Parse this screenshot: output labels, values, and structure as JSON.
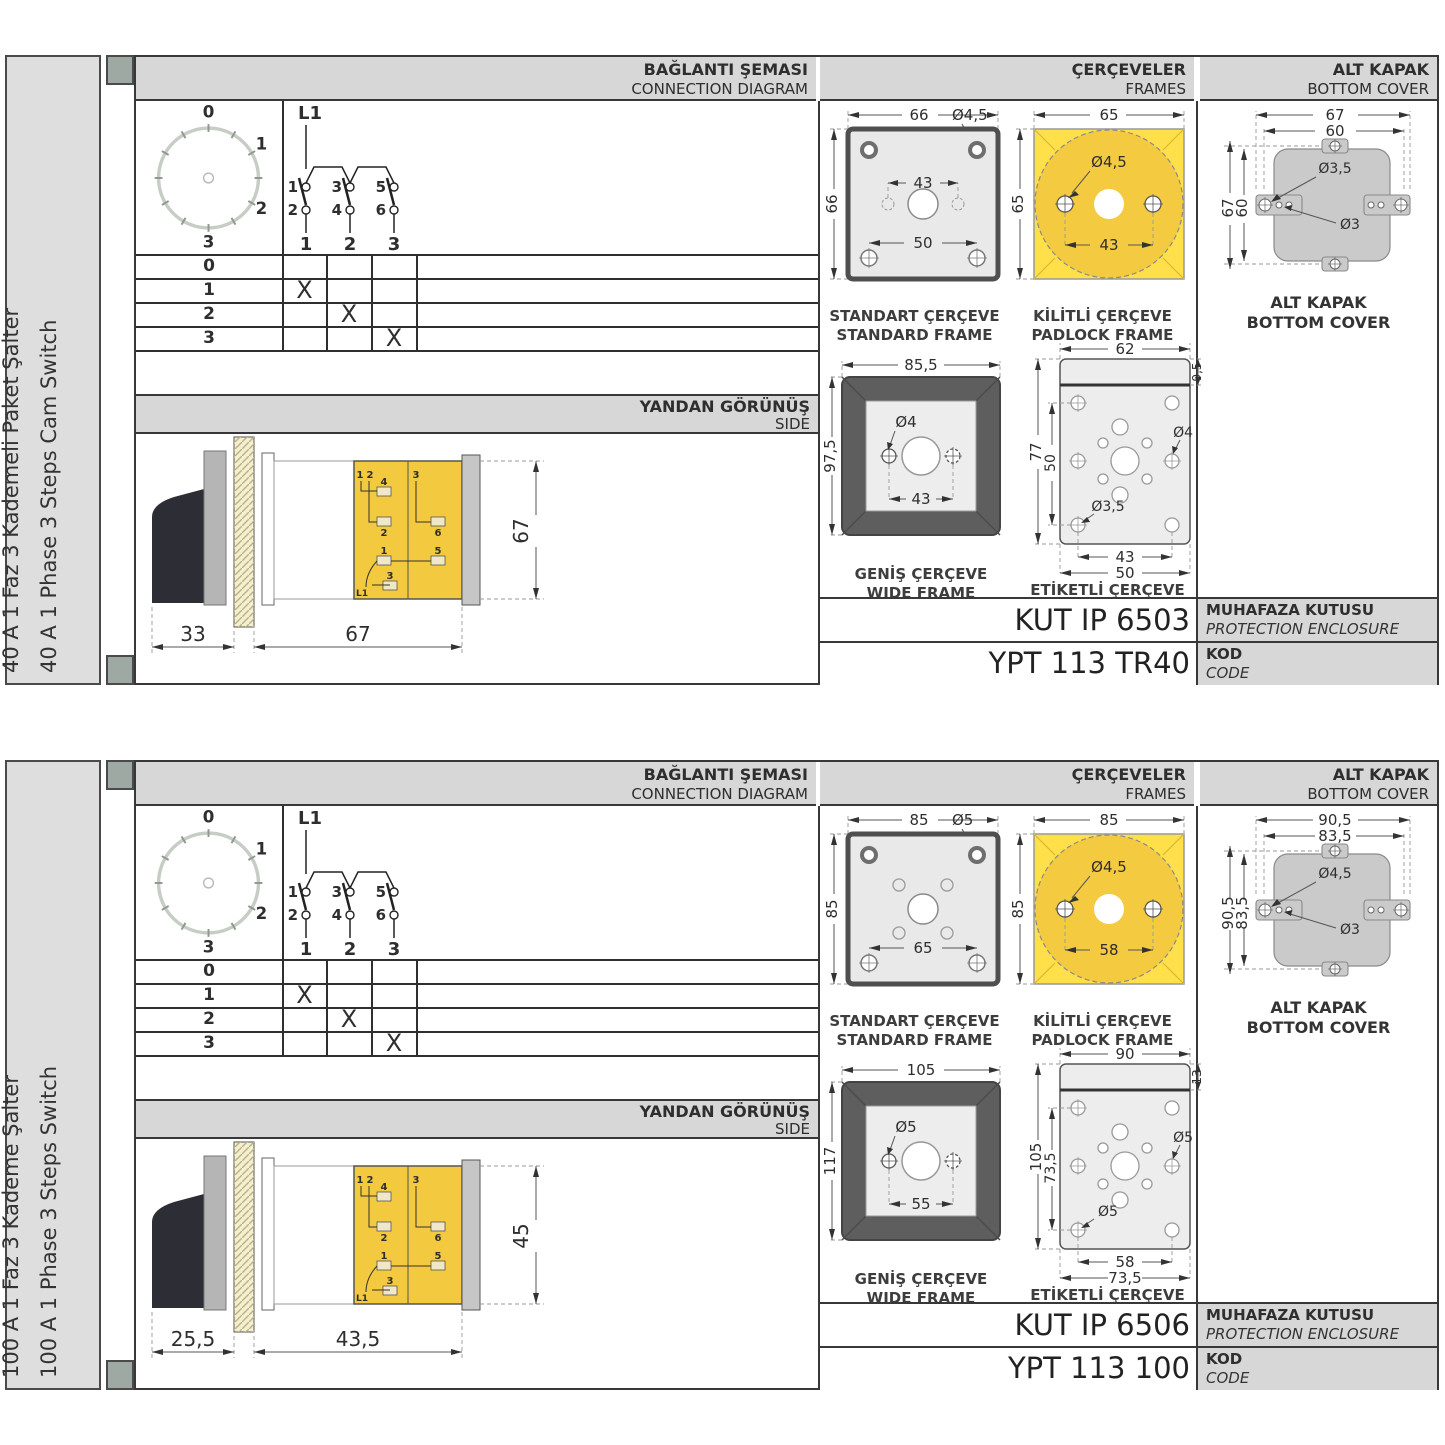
{
  "colors": {
    "panel_gray": "#d7d7d7",
    "sidebar_gray": "#dedede",
    "line_dark": "#383838",
    "yellow_square": "#ffe04a",
    "yellow_body": "#f3c93f",
    "frame_dark": "#5e5e5e",
    "frame_fill": "#e9e9e9",
    "cover_gray": "#cacaca",
    "handle_black": "#2d2d36",
    "binder_mark": "#9fa9a3",
    "dial_ring": "#c5cdc5"
  },
  "sections": [
    {
      "variant": "a",
      "sidebar": {
        "title_tr": "40 A 1 Faz 3 Kademeli Paket Şalter",
        "title_en": "40 A 1 Phase 3 Steps Cam Switch"
      },
      "headers": {
        "connection_tr": "BAĞLANTI ŞEMASI",
        "connection_en": "CONNECTION DIAGRAM",
        "frames_tr": "ÇERÇEVELER",
        "frames_en": "FRAMES",
        "cover_tr": "ALT KAPAK",
        "cover_en": "BOTTOM COVER",
        "side_tr": "YANDAN GÖRÜNÜŞ",
        "side_en": "SIDE"
      },
      "dial": {
        "p0": "0",
        "p1": "1",
        "p2": "2",
        "p3": "3"
      },
      "circuit": {
        "phase": "L1",
        "t1": "1",
        "t3": "3",
        "t5": "5",
        "b2": "2",
        "b4": "4",
        "b6": "6",
        "o1": "1",
        "o2": "2",
        "o3": "3"
      },
      "table": {
        "rows": [
          {
            "label": "0",
            "m1": "",
            "m2": "",
            "m3": ""
          },
          {
            "label": "1",
            "m1": "X",
            "m2": "",
            "m3": ""
          },
          {
            "label": "2",
            "m1": "",
            "m2": "X",
            "m3": ""
          },
          {
            "label": "3",
            "m1": "",
            "m2": "",
            "m3": "X"
          }
        ]
      },
      "side_view": {
        "dim_left": "33",
        "dim_right": "67",
        "dim_height": "67",
        "n1": "1",
        "n2": "2",
        "n4": "4",
        "n2b": "2",
        "n1b": "1",
        "n3": "3",
        "nl1": "L1",
        "m3": "3",
        "m6": "6",
        "m5": "5"
      },
      "frames": {
        "standard": {
          "title_tr": "STANDART ÇERÇEVE",
          "title_en": "STANDARD FRAME",
          "dim_w": "66",
          "dim_h": "66",
          "hole": "Ø4,5",
          "dim_inner": "43",
          "dim_outer": "50"
        },
        "padlock": {
          "title_tr": "KİLİTLİ ÇERÇEVE",
          "title_en": "PADLOCK FRAME",
          "dim_w": "65",
          "dim_h": "65",
          "hole": "Ø4,5",
          "dim_inner": "43"
        },
        "wide": {
          "title_tr": "GENİŞ ÇERÇEVE",
          "title_en": "WIDE FRAME",
          "dim_w": "85,5",
          "dim_h": "97,5",
          "hole": "Ø4",
          "dim_inner": "43"
        },
        "labelled": {
          "title_tr": "ETİKETLİ ÇERÇEVE",
          "title_en": "LABELLED FRAME",
          "dim_w": "62",
          "dim_band": "9,5",
          "dim_h": "77",
          "dim_inner_v": "50",
          "hole_right": "Ø4",
          "hole_left": "Ø3,5",
          "dim_b1": "43",
          "dim_b2": "50"
        }
      },
      "cover": {
        "title_tr": "ALT KAPAK",
        "title_en": "BOTTOM COVER",
        "dim_w1": "67",
        "dim_w2": "60",
        "dim_h1": "67",
        "dim_h2": "60",
        "hole1": "Ø3,5",
        "hole2": "Ø3"
      },
      "codes": {
        "enclosure_value": "KUT IP 6503",
        "enclosure_tr": "MUHAFAZA KUTUSU",
        "enclosure_en": "PROTECTION ENCLOSURE",
        "code_value": "YPT 113 TR40",
        "code_tr": "KOD",
        "code_en": "CODE"
      }
    },
    {
      "variant": "b",
      "sidebar": {
        "title_tr": "100 A 1 Faz 3 Kademe Şalter",
        "title_en": "100 A 1 Phase 3 Steps Switch"
      },
      "headers": {
        "connection_tr": "BAĞLANTI ŞEMASI",
        "connection_en": "CONNECTION DIAGRAM",
        "frames_tr": "ÇERÇEVELER",
        "frames_en": "FRAMES",
        "cover_tr": "ALT KAPAK",
        "cover_en": "BOTTOM COVER",
        "side_tr": "YANDAN GÖRÜNÜŞ",
        "side_en": "SIDE"
      },
      "dial": {
        "p0": "0",
        "p1": "1",
        "p2": "2",
        "p3": "3"
      },
      "circuit": {
        "phase": "L1",
        "t1": "1",
        "t3": "3",
        "t5": "5",
        "b2": "2",
        "b4": "4",
        "b6": "6",
        "o1": "1",
        "o2": "2",
        "o3": "3"
      },
      "table": {
        "rows": [
          {
            "label": "0",
            "m1": "",
            "m2": "",
            "m3": ""
          },
          {
            "label": "1",
            "m1": "X",
            "m2": "",
            "m3": ""
          },
          {
            "label": "2",
            "m1": "",
            "m2": "X",
            "m3": ""
          },
          {
            "label": "3",
            "m1": "",
            "m2": "",
            "m3": "X"
          }
        ]
      },
      "side_view": {
        "dim_left": "25,5",
        "dim_right": "43,5",
        "dim_height": "45",
        "n1": "1",
        "n2": "2",
        "n4": "4",
        "n2b": "2",
        "n1b": "1",
        "n3": "3",
        "nl1": "L1",
        "m3": "3",
        "m6": "6",
        "m5": "5"
      },
      "frames": {
        "standard": {
          "title_tr": "STANDART ÇERÇEVE",
          "title_en": "STANDARD FRAME",
          "dim_w": "85",
          "dim_h": "85",
          "hole": "Ø5",
          "dim_inner": "",
          "dim_outer": "65"
        },
        "padlock": {
          "title_tr": "KİLİTLİ ÇERÇEVE",
          "title_en": "PADLOCK FRAME",
          "dim_w": "85",
          "dim_h": "85",
          "hole": "Ø4,5",
          "dim_inner": "58"
        },
        "wide": {
          "title_tr": "GENİŞ ÇERÇEVE",
          "title_en": "WIDE FRAME",
          "dim_w": "105",
          "dim_h": "117",
          "hole": "Ø5",
          "dim_inner": "55"
        },
        "labelled": {
          "title_tr": "ETİKETLİ ÇERÇEVE",
          "title_en": "LABELLED FRAME",
          "dim_w": "90",
          "dim_band": "13",
          "dim_h": "105",
          "dim_inner_v": "73,5",
          "hole_right": "Ø5",
          "hole_left": "Ø5",
          "dim_b1": "58",
          "dim_b2": "73,5"
        }
      },
      "cover": {
        "title_tr": "ALT KAPAK",
        "title_en": "BOTTOM COVER",
        "dim_w1": "90,5",
        "dim_w2": "83,5",
        "dim_h1": "90,5",
        "dim_h2": "83,5",
        "hole1": "Ø4,5",
        "hole2": "Ø3"
      },
      "codes": {
        "enclosure_value": "KUT IP 6506",
        "enclosure_tr": "MUHAFAZA KUTUSU",
        "enclosure_en": "PROTECTION ENCLOSURE",
        "code_value": "YPT 113 100",
        "code_tr": "KOD",
        "code_en": "CODE"
      }
    }
  ]
}
